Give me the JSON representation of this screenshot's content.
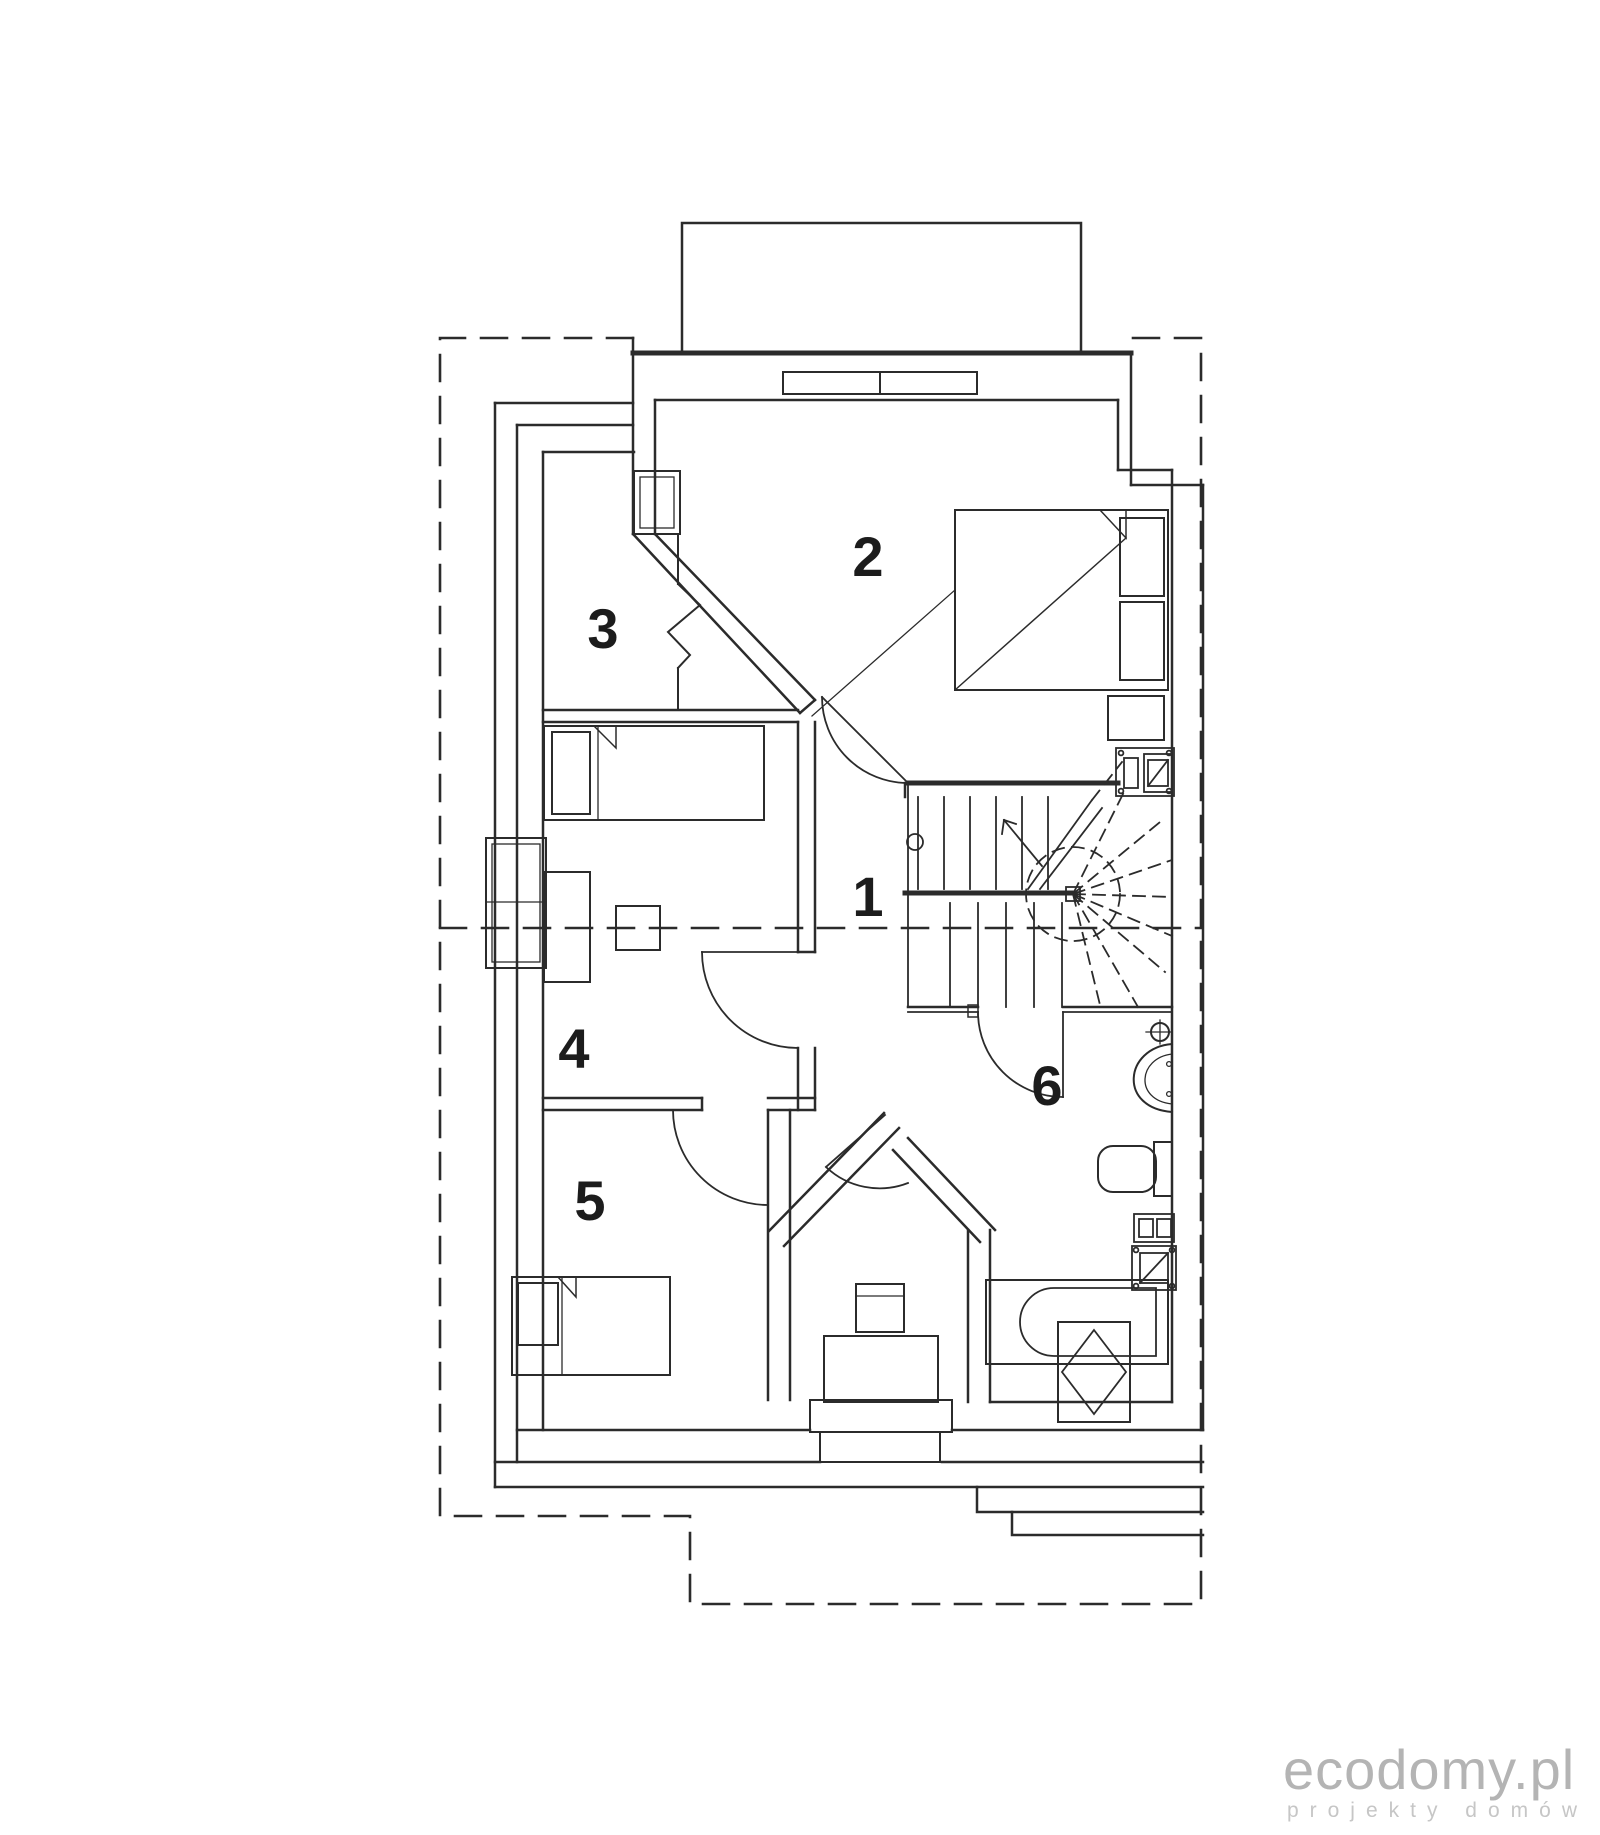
{
  "plan": {
    "type": "attic-floor-plan",
    "room_labels": [
      {
        "id": "room-1",
        "number": "1"
      },
      {
        "id": "room-2",
        "number": "2"
      },
      {
        "id": "room-3",
        "number": "3"
      },
      {
        "id": "room-4",
        "number": "4"
      },
      {
        "id": "room-5",
        "number": "5"
      },
      {
        "id": "room-6",
        "number": "6"
      }
    ],
    "features": [
      "dashed-roof-outline",
      "attic-kneewall-dashed-line",
      "winder-staircase",
      "double-bed",
      "single-bed-room4",
      "single-bed-room5",
      "bathtub",
      "washbasin",
      "toilet",
      "ventilation-shafts",
      "doors-with-swing-arcs",
      "windows",
      "desk",
      "stools",
      "dormer-outline"
    ]
  },
  "logo": {
    "title": "ecodomy.pl",
    "subtitle": "projekty  domów"
  },
  "colors": {
    "line": "#2b2b2b",
    "background": "#ffffff",
    "logo_title": "#b4b4b4",
    "logo_subtitle": "#c6c6c6"
  }
}
